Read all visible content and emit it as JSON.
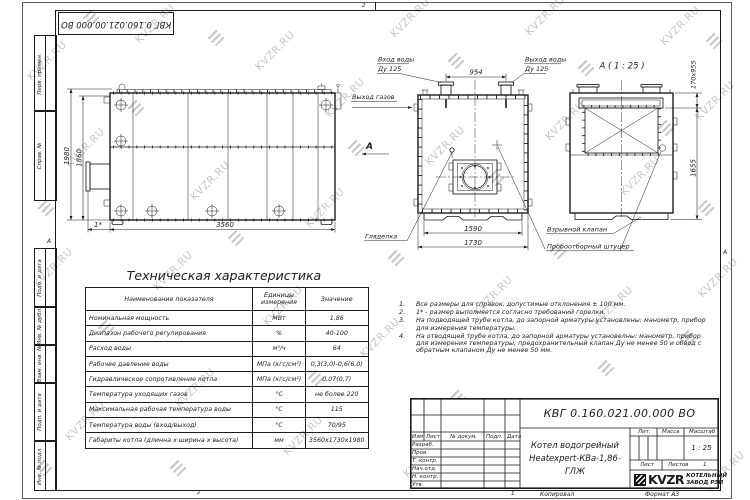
{
  "watermark": {
    "text": "KVZR.RU",
    "color": "#c9c9c9",
    "text_positions": [
      [
        22,
        55
      ],
      [
        130,
        18
      ],
      [
        250,
        45
      ],
      [
        320,
        92
      ],
      [
        385,
        12
      ],
      [
        520,
        10
      ],
      [
        655,
        20
      ],
      [
        690,
        95
      ],
      [
        60,
        142
      ],
      [
        185,
        175
      ],
      [
        300,
        202
      ],
      [
        420,
        140
      ],
      [
        540,
        115
      ],
      [
        615,
        170
      ],
      [
        28,
        262
      ],
      [
        148,
        265
      ],
      [
        258,
        300
      ],
      [
        355,
        332
      ],
      [
        468,
        290
      ],
      [
        588,
        300
      ],
      [
        693,
        272
      ],
      [
        60,
        415
      ],
      [
        170,
        382
      ],
      [
        278,
        430
      ],
      [
        398,
        452
      ],
      [
        515,
        430
      ],
      [
        638,
        420
      ],
      [
        700,
        465
      ]
    ],
    "glyph_positions": [
      [
        85,
        12
      ],
      [
        210,
        32
      ],
      [
        450,
        55
      ],
      [
        580,
        62
      ],
      [
        708,
        35
      ],
      [
        130,
        102
      ],
      [
        350,
        142
      ],
      [
        490,
        172
      ],
      [
        660,
        122
      ],
      [
        40,
        202
      ],
      [
        230,
        232
      ],
      [
        390,
        252
      ],
      [
        552,
        245
      ],
      [
        700,
        202
      ],
      [
        100,
        322
      ],
      [
        310,
        372
      ],
      [
        452,
        392
      ],
      [
        600,
        362
      ],
      [
        172,
        462
      ],
      [
        560,
        470
      ],
      [
        682,
        332
      ],
      [
        38,
        462
      ]
    ]
  },
  "stamp_top": "КВГ 0.160.021.00.000 ВО",
  "margin_fields": {
    "f1": "Перв. примен.",
    "f2": "Справ. №",
    "f3": "Подп. и дата",
    "f4": "Инв. № дубл.",
    "f5": "Взам. инв. №",
    "f6": "Подп. и дата",
    "f7": "Инв. № подл."
  },
  "fold_marks": {
    "left": "А",
    "right": "А",
    "top_zone": "2",
    "bottom_zone": "2",
    "bottom_zone_right": "1"
  },
  "views": {
    "side": {
      "dims": {
        "h1": "1980",
        "h2": "1860",
        "w": "3560",
        "burner": "1*"
      }
    },
    "front": {
      "section_letter": "А",
      "dims": {
        "nozzles": "954",
        "skid": "1590",
        "w": "1730"
      },
      "labels": {
        "inlet1": "Вход воды",
        "inlet2": "Ду 125",
        "outlet1": "Выход воды",
        "outlet2": "Ду 125",
        "gas": "Выход газов",
        "sight": "Гляделка"
      }
    },
    "a_view": {
      "title": "А ( 1 : 25 )",
      "dims": {
        "top": "170х955",
        "h": "1655"
      },
      "labels": {
        "valve": "Взрывной клапан",
        "sampler": "Пробоотборный штуцер"
      }
    }
  },
  "tech_table": {
    "title": "Техническая характеристика",
    "col_name": "Наименование показателя",
    "col_units_1": "Единицы",
    "col_units_2": "измерения",
    "col_value": "Значение",
    "rows": [
      {
        "name": "Номинальная мощность",
        "units": "МВт",
        "value": "1,86"
      },
      {
        "name": "Диапазон рабочего регулирования",
        "units": "%",
        "value": "40-100"
      },
      {
        "name": "Расход воды",
        "units": "м³/ч",
        "value": "64"
      },
      {
        "name": "Рабочее давление воды",
        "units": "МПа (кгс/см²)",
        "value": "0,3(3,0)-0,6(6,0)"
      },
      {
        "name": "Гидравлическое сопротивление котла",
        "units": "МПа (кгс/см²)",
        "value": "0,07(0,7)"
      },
      {
        "name": "Температура уходящих газов",
        "units": "°С",
        "value": "не более 220"
      },
      {
        "name": "Максимальная рабочая температура воды",
        "units": "°С",
        "value": "115"
      },
      {
        "name": "Температура воды (вход/выход)",
        "units": "°С",
        "value": "70/95"
      },
      {
        "name": "Габариты котла (длинна х ширина х высота)",
        "units": "мм",
        "value": "3560х1730х1980"
      }
    ]
  },
  "notes": {
    "items": [
      {
        "num": "1.",
        "text": "Все размеры для справок, допустимые отклонения ± 100 мм."
      },
      {
        "num": "2.",
        "text": "1* - размер выполняется согласно требований горелки."
      },
      {
        "num": "3.",
        "text": "На подводящей трубе котла, до запорной арматуры установлены: манометр, прибор для измерения температуры."
      },
      {
        "num": "4.",
        "text": "На отводящей трубе котла, до запорной арматуры установелны: манометр, прибор для измерения температуры, предохранительный клапан Ду не менее 50 и обвод с обратным клапаном Ду не менее 50 мм."
      }
    ]
  },
  "title_block": {
    "doc_number": "КВГ 0.160.021.00.000 ВО",
    "product_line1": "Котел водогрейный",
    "product_line2": "Heatexpert-КВа-1,86-ГЛЖ",
    "rev_headers": [
      "Изм",
      "Лист",
      "№ докум.",
      "Подп.",
      "Дата"
    ],
    "roles": [
      "Разраб.",
      "Пров.",
      "Т. контр.",
      "Нач.отд.",
      "Н. контр.",
      "Утв."
    ],
    "lit_label": "Лит.",
    "mass_label": "Масса",
    "scale_label": "Масштаб",
    "scale_value": "1 : 25",
    "sheet_label": "Лист",
    "sheets_label": "Листов",
    "sheets_value": "1",
    "logo_text": "KVZR",
    "company_line1": "КОТЕЛЬНЫЙ",
    "company_line2": "ЗАВОД РЭП"
  },
  "footer": {
    "copied": "Копировал",
    "format": "Формат А3"
  }
}
